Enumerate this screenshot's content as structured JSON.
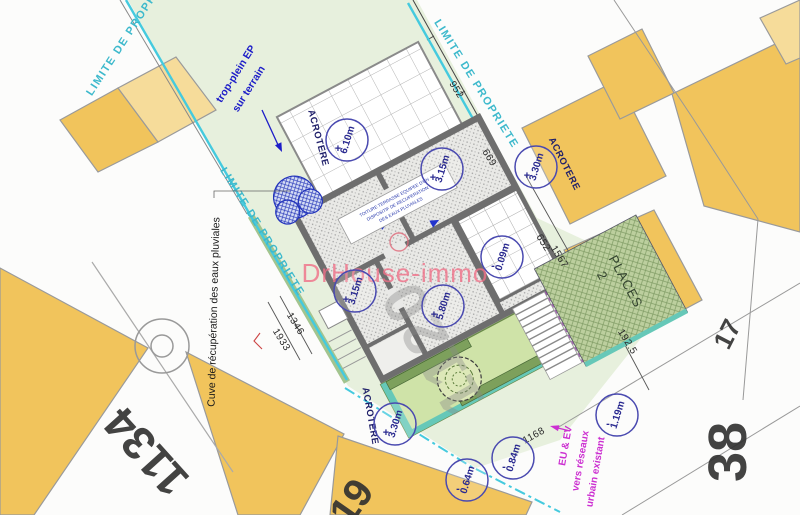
{
  "plan": {
    "watermark": "DrHouse-immo",
    "boundaries": {
      "top_left": "LIMITE DE PROPRIETE",
      "top_right": "LIMITE DE PROPRIETE",
      "left": "LIMITE DE PROPRIETE"
    },
    "acrotere": {
      "left": "ACROTERE",
      "right": "ACROTERE",
      "bottom": "ACROTERE"
    },
    "notes": {
      "trop_plein_1": "trop-plein EP",
      "trop_plein_2": "sur terrain",
      "cuve": "Cuve de récupération des eaux pluviales",
      "roof_1": "TOITURE TERRASSE EQUIPEE D'UN",
      "roof_2": "DISPOSITIF DE RECUPERATION",
      "roof_3": "DES EAUX PLUVIALES",
      "sewer_1": "EU & EV",
      "sewer_2": "vers réseaux",
      "sewer_3": "urbain existant",
      "parking_1": "2",
      "parking_2": "PLACES"
    },
    "survey": {
      "s952": "952",
      "s669": "669",
      "s652": "652",
      "s1567": "1567",
      "s1346": "1346",
      "s1933": "1933",
      "s1168": "1168",
      "s1925": "192.5"
    },
    "parcels": {
      "n1134": "1134",
      "n38": "38",
      "n17": "17",
      "n19": "19",
      "plot": "1120"
    },
    "bubbles": [
      {
        "value": "6.10m",
        "sign": "+"
      },
      {
        "value": "3.15m",
        "sign": "+"
      },
      {
        "value": "3.30m",
        "sign": "+"
      },
      {
        "value": "3.15m",
        "sign": "+"
      },
      {
        "value": "5.80m",
        "sign": "+"
      },
      {
        "value": "0.09m",
        "sign": "-"
      },
      {
        "value": "3.30m",
        "sign": "+"
      },
      {
        "value": "0.64m",
        "sign": "-"
      },
      {
        "value": "0.84m",
        "sign": "-"
      },
      {
        "value": "1.19m",
        "sign": "-"
      }
    ],
    "colors": {
      "boundary_cyan": "#45cade",
      "limite_label": "#3db9cc",
      "annotation_blue": "#1d1dc8",
      "sewer_magenta": "#cc2fd1",
      "watermark_pink": "#f07088",
      "building_yellow": "#f1c45c",
      "building_yellow_light": "#f6dc9a",
      "garden_green": "#cfe3a8",
      "plot_green": "#e7f0dd"
    }
  }
}
